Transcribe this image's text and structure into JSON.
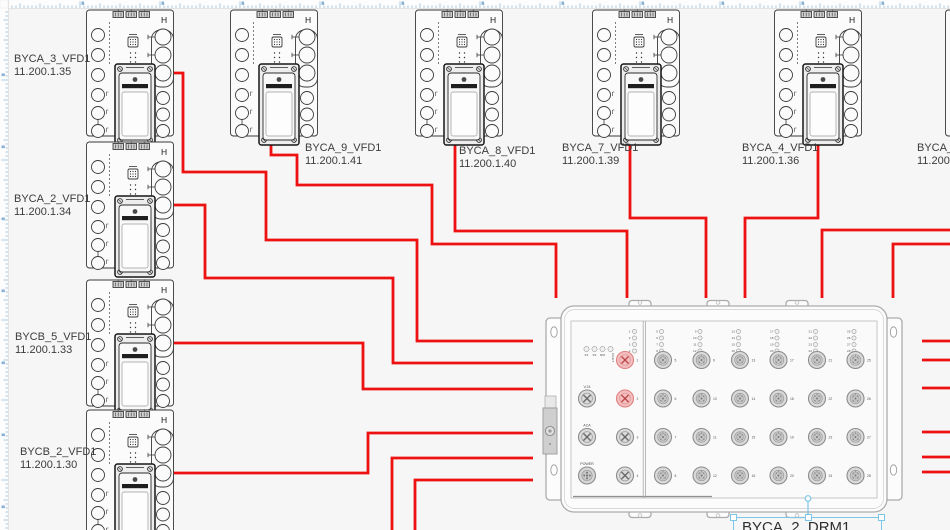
{
  "vfd": {
    "corner_label": "H"
  },
  "devices": [
    {
      "name": "BYCA_3_VFD1",
      "ip": "11.200.1.35",
      "x": 85,
      "y": 8,
      "label": {
        "x": 14,
        "y": 53
      }
    },
    {
      "name": "BYCA_2_VFD1",
      "ip": "11.200.1.34",
      "x": 85,
      "y": 140,
      "label": {
        "x": 14,
        "y": 193
      }
    },
    {
      "name": "BYCB_5_VFD1",
      "ip": "11.200.1.33",
      "x": 85,
      "y": 278,
      "label": {
        "x": 15,
        "y": 331
      }
    },
    {
      "name": "BYCB_2_VFD1",
      "ip": "11.200.1.30",
      "x": 85,
      "y": 408,
      "label": {
        "x": 20,
        "y": 446
      }
    },
    {
      "name": "BYCA_9_VFD1",
      "ip": "11.200.1.41",
      "x": 229,
      "y": 8,
      "label": {
        "x": 305,
        "y": 142
      }
    },
    {
      "name": "BYCA_8_VFD1",
      "ip": "11.200.1.40",
      "x": 414,
      "y": 8,
      "label": {
        "x": 459,
        "y": 145
      }
    },
    {
      "name": "BYCA_7_VFD1",
      "ip": "11.200.1.39",
      "x": 591,
      "y": 8,
      "label": {
        "x": 562,
        "y": 142
      }
    },
    {
      "name": "BYCA_4_VFD1",
      "ip": "11.200.1.36",
      "x": 773,
      "y": 8,
      "label": {
        "x": 742,
        "y": 142
      }
    },
    {
      "name": "BYCA_5_",
      "ip": "11.200.1",
      "x": 944,
      "y": 8,
      "label": {
        "x": 917,
        "y": 142
      }
    }
  ],
  "drm_switch": {
    "status_leds": [
      "P1",
      "P2",
      "RM"
    ],
    "fault_led": "FAULT",
    "aux_port_labels": [
      "V.24",
      "ACA",
      "POWER"
    ],
    "led_cluster_left": [
      "1",
      "2",
      "3",
      "4"
    ],
    "left_ports": [
      {
        "n": "1",
        "active": true
      },
      {
        "n": "2",
        "active": true
      },
      {
        "n": "3",
        "active": false
      },
      {
        "n": "4",
        "active": false
      }
    ],
    "port_columns": [
      [
        "5",
        "6",
        "7",
        "8"
      ],
      [
        "9",
        "10",
        "11",
        "12"
      ],
      [
        "13",
        "14",
        "15",
        "16"
      ],
      [
        "17",
        "18",
        "19",
        "20"
      ],
      [
        "21",
        "22",
        "23",
        "24"
      ],
      [
        "25",
        "26",
        "27",
        "28"
      ]
    ]
  },
  "selection": {
    "label": "BYCA_2_DRM1"
  },
  "wires": [
    {
      "points": [
        [
          174,
          73
        ],
        [
          183,
          73
        ],
        [
          183,
          172
        ],
        [
          266,
          172
        ],
        [
          266,
          240
        ],
        [
          417,
          240
        ],
        [
          417,
          341
        ],
        [
          533,
          341
        ]
      ]
    },
    {
      "points": [
        [
          174,
          205
        ],
        [
          205,
          205
        ],
        [
          205,
          278
        ],
        [
          393,
          278
        ],
        [
          393,
          363
        ],
        [
          533,
          363
        ]
      ]
    },
    {
      "points": [
        [
          174,
          343
        ],
        [
          363,
          343
        ],
        [
          363,
          389
        ],
        [
          533,
          389
        ]
      ]
    },
    {
      "points": [
        [
          174,
          473
        ],
        [
          368,
          473
        ],
        [
          368,
          433
        ],
        [
          533,
          433
        ]
      ]
    },
    {
      "points": [
        [
          392,
          532
        ],
        [
          392,
          458
        ],
        [
          533,
          458
        ]
      ]
    },
    {
      "points": [
        [
          415,
          532
        ],
        [
          415,
          480
        ],
        [
          533,
          480
        ]
      ]
    },
    {
      "points": [
        [
          271,
          140
        ],
        [
          271,
          155
        ],
        [
          297,
          155
        ],
        [
          297,
          185
        ],
        [
          432,
          185
        ],
        [
          432,
          244
        ],
        [
          556,
          244
        ],
        [
          556,
          298
        ]
      ]
    },
    {
      "points": [
        [
          455,
          143
        ],
        [
          455,
          231
        ],
        [
          627,
          231
        ],
        [
          627,
          298
        ]
      ]
    },
    {
      "points": [
        [
          630,
          140
        ],
        [
          630,
          218
        ],
        [
          706,
          218
        ],
        [
          706,
          298
        ]
      ]
    },
    {
      "points": [
        [
          818,
          140
        ],
        [
          818,
          218
        ],
        [
          745,
          218
        ],
        [
          745,
          298
        ]
      ]
    },
    {
      "points": [
        [
          952,
          230
        ],
        [
          822,
          230
        ],
        [
          822,
          298
        ]
      ]
    },
    {
      "points": [
        [
          952,
          244
        ],
        [
          893,
          244
        ],
        [
          893,
          298
        ]
      ]
    },
    {
      "points": [
        [
          922,
          341
        ],
        [
          952,
          341
        ]
      ]
    },
    {
      "points": [
        [
          922,
          360
        ],
        [
          952,
          360
        ]
      ]
    },
    {
      "points": [
        [
          922,
          388
        ],
        [
          952,
          388
        ]
      ]
    },
    {
      "points": [
        [
          922,
          432
        ],
        [
          952,
          432
        ]
      ]
    },
    {
      "points": [
        [
          922,
          457
        ],
        [
          952,
          457
        ]
      ]
    },
    {
      "points": [
        [
          922,
          472
        ],
        [
          952,
          472
        ]
      ]
    }
  ],
  "colors": {
    "wire": "#ee1111",
    "selection": "#7cc6e8",
    "port_active_fill": "#f5bfbf",
    "port_active_stroke": "#df8080",
    "ruler_tick": "#a9c9e2",
    "ruler_number": "#74a3cf"
  }
}
